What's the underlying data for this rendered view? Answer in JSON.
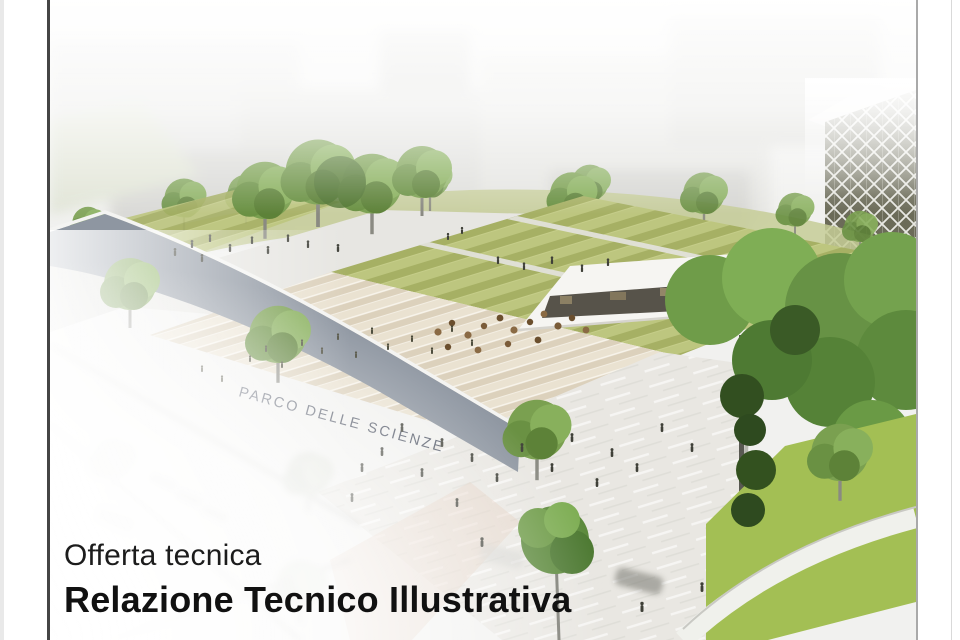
{
  "page": {
    "margin_color": "#ffffff",
    "edge_strip_color": "#e9e9e9",
    "border_left_color": "#454545",
    "border_right_color": "#a9a9a9",
    "faint_line_color": "#d9d9d9"
  },
  "document": {
    "kicker": "Offerta tecnica",
    "title": "Relazione Tecnico Illustrativa",
    "text_color": "#1c1c1c"
  },
  "rendering": {
    "alt": "Aerial architectural rendering of the Parco delle Scienze: terraced striped lawns, wide amphitheater steps and a public plaza with scattered people, green trees, a white canopy pavilion with cafe tables, a diagonal-grid tower at right, all above a faded hillside town and street",
    "building_sign": "PARCO DELLE SCIENZE",
    "palette": {
      "sky_haze": "#f1f1ef",
      "sign_color": "#454c5c",
      "wall_gray": "#8e96a1",
      "lawn_light": "#bdc67f",
      "lawn_dark": "#a6b064",
      "grass_bright": "#a3bf54",
      "tree_green": "#6f9c49",
      "plaza": "#e9e7e2",
      "steps_cream": "#eae2d1",
      "facade_dark": "#6b6b58",
      "canopy_white": "#f6f5f2"
    }
  }
}
